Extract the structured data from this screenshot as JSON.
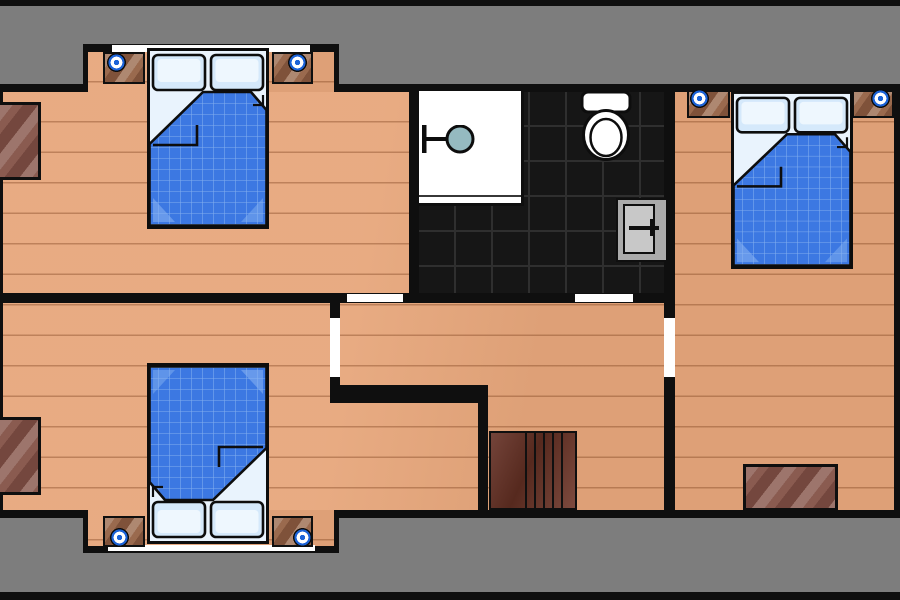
{
  "meta": {
    "type": "architectural-floor-plan",
    "width": 900,
    "height": 600,
    "visible_text": "none"
  },
  "palette": {
    "background": "#7d7d7d",
    "wall": "#0f0f0f",
    "wood": "#e7a77c",
    "wood_line": "#b5754a",
    "tile": "#161616",
    "tile_line": "#2f2f2f",
    "opening": "#ffffff",
    "white": "#ffffff",
    "rug": "#8a5b50",
    "rug_light": "#a67c6f",
    "nightstand": "#9a6a4e",
    "nightstand_light": "#b58a6b",
    "lamp_blue": "#1c63d8",
    "blanket": "#3c78e2",
    "blanket_grid": "#93bcf2",
    "sheet": "#e9f3fd",
    "pillow": "#d5e9fb",
    "stairs_dark": "#56291e",
    "stairs_light": "#7d4a3e",
    "door_frame": "#ababab",
    "door_panel": "#c8c8c8",
    "shower_head": "#95bac0"
  },
  "layout": {
    "boxes": [
      {
        "name": "floor-main",
        "kind": "floor-wood",
        "x": 0,
        "y": 92,
        "w": 894,
        "h": 418
      },
      {
        "name": "floor-top-protrusion",
        "kind": "floor-wood",
        "x": 88,
        "y": 52,
        "w": 246,
        "h": 40
      },
      {
        "name": "floor-bottom-protrusion",
        "kind": "floor-wood",
        "x": 88,
        "y": 510,
        "w": 246,
        "h": 36
      },
      {
        "name": "floor-bathroom-tiles",
        "kind": "floor-tile",
        "x": 419,
        "y": 92,
        "w": 245,
        "h": 211
      },
      {
        "name": "image-top-border",
        "kind": "wall",
        "x": 0,
        "y": 0,
        "w": 900,
        "h": 6
      },
      {
        "name": "image-bottom-border",
        "kind": "wall",
        "x": 0,
        "y": 592,
        "w": 900,
        "h": 8
      },
      {
        "name": "wall-top-left",
        "kind": "wall",
        "x": 0,
        "y": 84,
        "w": 88,
        "h": 8
      },
      {
        "name": "wall-protrusion-left",
        "kind": "wall",
        "x": 83,
        "y": 44,
        "w": 5,
        "h": 48
      },
      {
        "name": "wall-protrusion-top",
        "kind": "wall",
        "x": 83,
        "y": 44,
        "w": 256,
        "h": 8
      },
      {
        "name": "wall-protrusion-right",
        "kind": "wall",
        "x": 334,
        "y": 44,
        "w": 5,
        "h": 48
      },
      {
        "name": "wall-top-main",
        "kind": "wall",
        "x": 334,
        "y": 84,
        "w": 566,
        "h": 8
      },
      {
        "name": "wall-right-edge",
        "kind": "wall",
        "x": 894,
        "y": 84,
        "w": 6,
        "h": 434
      },
      {
        "name": "wall-left-edge",
        "kind": "wall",
        "x": 0,
        "y": 92,
        "w": 3,
        "h": 418
      },
      {
        "name": "wall-middle-horizontal",
        "kind": "wall",
        "x": 0,
        "y": 293,
        "w": 675,
        "h": 10
      },
      {
        "name": "wall-bathroom-left",
        "kind": "wall",
        "x": 409,
        "y": 92,
        "w": 10,
        "h": 211
      },
      {
        "name": "wall-hallway-right",
        "kind": "wall",
        "x": 664,
        "y": 92,
        "w": 11,
        "h": 426
      },
      {
        "name": "wall-hallway-left",
        "kind": "wall",
        "x": 330,
        "y": 303,
        "w": 10,
        "h": 82
      },
      {
        "name": "wall-hallway-bottom",
        "kind": "wall",
        "x": 330,
        "y": 385,
        "w": 158,
        "h": 18
      },
      {
        "name": "wall-stairwell",
        "kind": "wall",
        "x": 478,
        "y": 403,
        "w": 10,
        "h": 115
      },
      {
        "name": "wall-bottom-left",
        "kind": "wall",
        "x": 0,
        "y": 510,
        "w": 88,
        "h": 8
      },
      {
        "name": "wall-bottom-protrusion-left",
        "kind": "wall",
        "x": 83,
        "y": 518,
        "w": 5,
        "h": 34
      },
      {
        "name": "wall-bottom-protrusion-bottom",
        "kind": "wall",
        "x": 83,
        "y": 546,
        "w": 256,
        "h": 7
      },
      {
        "name": "wall-bottom-protrusion-right",
        "kind": "wall",
        "x": 334,
        "y": 518,
        "w": 5,
        "h": 34
      },
      {
        "name": "wall-bottom-main",
        "kind": "wall",
        "x": 334,
        "y": 510,
        "w": 566,
        "h": 8
      },
      {
        "name": "doorway-top-bedroom",
        "kind": "opening",
        "x": 347,
        "y": 294,
        "w": 56,
        "h": 8
      },
      {
        "name": "doorway-bathroom",
        "kind": "opening",
        "x": 575,
        "y": 294,
        "w": 58,
        "h": 8
      },
      {
        "name": "doorway-bottom-bedroom",
        "kind": "opening",
        "x": 330,
        "y": 318,
        "w": 10,
        "h": 59
      },
      {
        "name": "doorway-right-bedroom",
        "kind": "opening",
        "x": 664,
        "y": 318,
        "w": 11,
        "h": 59
      },
      {
        "name": "window-top-protrusion",
        "kind": "opening",
        "x": 112,
        "y": 45,
        "w": 198,
        "h": 7
      },
      {
        "name": "window-bottom-protrusion",
        "kind": "opening",
        "x": 108,
        "y": 545,
        "w": 207,
        "h": 6
      },
      {
        "name": "staircase",
        "kind": "stairs",
        "x": 489,
        "y": 431,
        "w": 88,
        "h": 79
      },
      {
        "name": "rug-top-left",
        "kind": "rug",
        "cls": "edge-left",
        "x": 0,
        "y": 102,
        "w": 41,
        "h": 78
      },
      {
        "name": "rug-bottom-left",
        "kind": "rug",
        "cls": "edge-left",
        "x": 0,
        "y": 417,
        "w": 41,
        "h": 78
      },
      {
        "name": "rug-right-bedroom",
        "kind": "rug",
        "x": 743,
        "y": 464,
        "w": 95,
        "h": 47
      },
      {
        "name": "nightstand-top-left-a",
        "kind": "nightstand",
        "x": 103,
        "y": 52,
        "w": 42,
        "h": 32
      },
      {
        "name": "nightstand-top-left-b",
        "kind": "nightstand",
        "x": 272,
        "y": 52,
        "w": 41,
        "h": 32
      },
      {
        "name": "nightstand-right-a",
        "kind": "nightstand",
        "x": 687,
        "y": 90,
        "w": 43,
        "h": 28
      },
      {
        "name": "nightstand-right-b",
        "kind": "nightstand",
        "x": 852,
        "y": 90,
        "w": 42,
        "h": 28
      },
      {
        "name": "nightstand-bottom-left-a",
        "kind": "nightstand",
        "x": 103,
        "y": 516,
        "w": 42,
        "h": 31
      },
      {
        "name": "nightstand-bottom-left-b",
        "kind": "nightstand",
        "x": 272,
        "y": 516,
        "w": 41,
        "h": 31
      },
      {
        "name": "lamp-top-left-a",
        "kind": "lamp",
        "x": 107,
        "y": 53,
        "w": 19,
        "h": 19
      },
      {
        "name": "lamp-top-left-b",
        "kind": "lamp",
        "x": 288,
        "y": 53,
        "w": 19,
        "h": 19
      },
      {
        "name": "lamp-right-a",
        "kind": "lamp",
        "x": 690,
        "y": 89,
        "w": 19,
        "h": 19
      },
      {
        "name": "lamp-right-b",
        "kind": "lamp",
        "x": 871,
        "y": 89,
        "w": 19,
        "h": 19
      },
      {
        "name": "lamp-bottom-left-a",
        "kind": "lamp",
        "x": 110,
        "y": 528,
        "w": 19,
        "h": 19
      },
      {
        "name": "lamp-bottom-left-b",
        "kind": "lamp",
        "x": 293,
        "y": 528,
        "w": 19,
        "h": 19
      }
    ]
  },
  "furniture": {
    "beds": [
      {
        "name": "double-bed-top-left",
        "x": 147,
        "y": 48,
        "w": 122,
        "h": 181,
        "orientation": "pillows-top"
      },
      {
        "name": "double-bed-bottom-left",
        "x": 147,
        "y": 363,
        "w": 122,
        "h": 181,
        "orientation": "pillows-bottom"
      },
      {
        "name": "double-bed-right",
        "x": 731,
        "y": 91,
        "w": 122,
        "h": 178,
        "orientation": "pillows-top"
      }
    ],
    "bathroom": {
      "shower": {
        "x": 419,
        "y": 91,
        "w": 102,
        "h": 112
      },
      "toilet": {
        "x": 580,
        "y": 90,
        "w": 54,
        "h": 72
      },
      "door": {
        "x": 616,
        "y": 198,
        "w": 48,
        "h": 60
      }
    },
    "staircase": {
      "treads": 8
    }
  }
}
